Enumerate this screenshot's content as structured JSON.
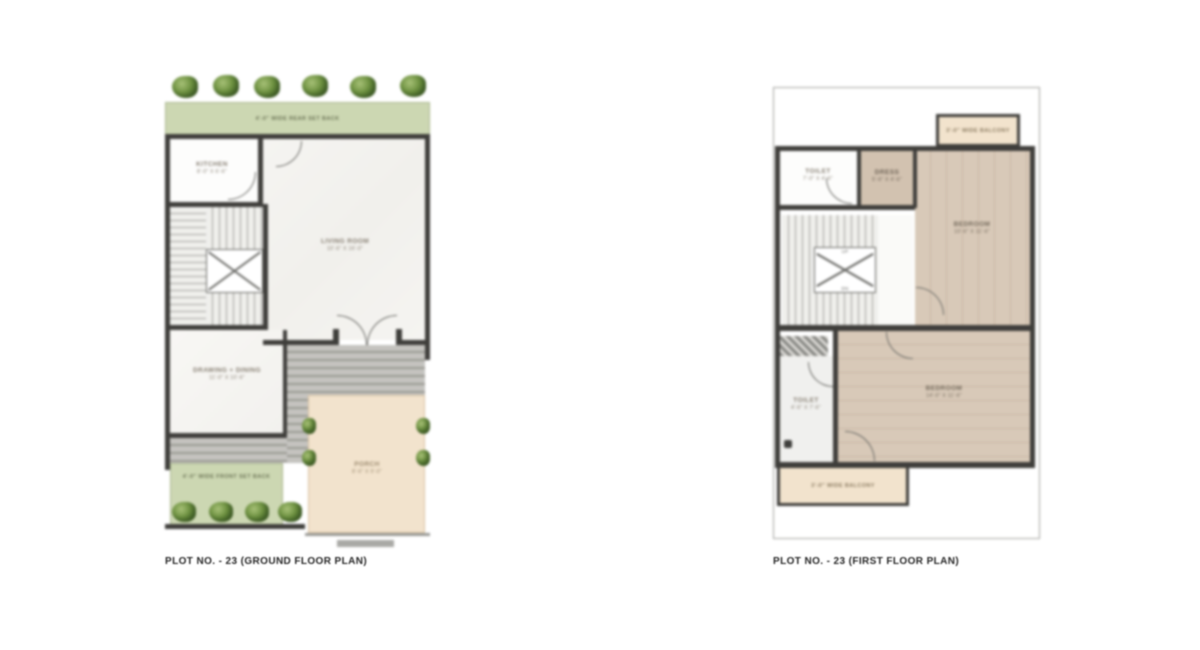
{
  "sheet": {
    "ground_floor": {
      "caption": "PLOT NO. - 23 (GROUND FLOOR PLAN)",
      "rear_setback_label": "4'-0\" WIDE REAR SET BACK",
      "front_setback_label": "4'-0\" WIDE FRONT SET BACK",
      "rooms": {
        "kitchen": {
          "name": "KITCHEN",
          "dims": "8'-0\" X 6'-6\""
        },
        "living": {
          "name": "LIVING ROOM",
          "dims": "10'-6\" X 16'-0\""
        },
        "drawing_dining": {
          "name": "DRAWING + DINING",
          "dims": "11'-0\" X 10'-6\""
        },
        "porch": {
          "name": "PORCH",
          "dims": "8'-6\" X 9'-0\""
        }
      }
    },
    "first_floor": {
      "caption": "PLOT NO. - 23 (FIRST FLOOR PLAN)",
      "balcony_top_label": "3'-0\" WIDE BALCONY",
      "balcony_bottom_label": "3'-0\" WIDE BALCONY",
      "stair": {
        "up_label": "UP",
        "dn_label": "DN"
      },
      "rooms": {
        "toilet_top": {
          "name": "TOILET",
          "dims": "7'-0\" X 4'-6\""
        },
        "dress": {
          "name": "DRESS",
          "dims": "5'-6\" X 4'-6\""
        },
        "bedroom_top": {
          "name": "BEDROOM",
          "dims": "10'-6\" X 11'-6\""
        },
        "toilet_bottom": {
          "name": "TOILET",
          "dims": "4'-6\" X 7'-6\""
        },
        "bedroom_bottom": {
          "name": "BEDROOM",
          "dims": "14'-0\" X 11'-6\""
        }
      }
    }
  },
  "colors": {
    "wall": "#3f3e3b",
    "setback_green": "#ccd7b2",
    "balcony_beige": "#f2e3cd",
    "wood_floor": "#d8c9b8",
    "steps_gray": "#bfbeba",
    "plant_green": "#6d9140"
  }
}
